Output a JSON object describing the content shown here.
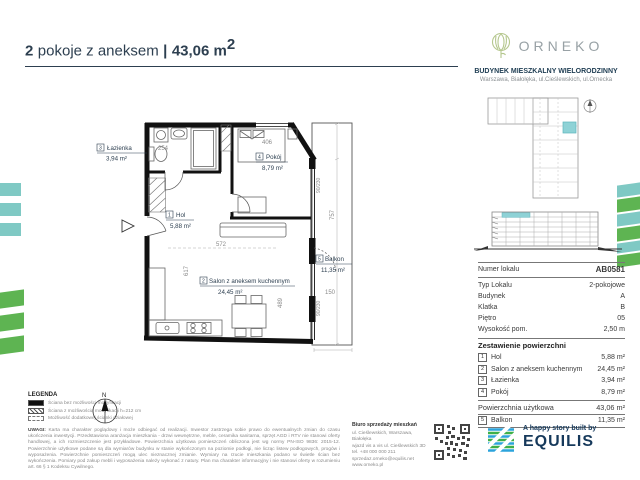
{
  "header": {
    "rooms": "2",
    "title": "pokoje z aneksem",
    "sep": "|",
    "area": "43,06 m",
    "area_sup": "2"
  },
  "brand": {
    "name": "ORNEKO",
    "building": "BUDYNEK MIESZKALNY WIELORODZINNY",
    "address": "Warszawa, Białołęka, ul.Cieślewskich, ul.Ornecka"
  },
  "unit": {
    "numer_label": "Numer lokalu",
    "numer": "AB0581",
    "info_rows": [
      {
        "label": "Typ Lokalu",
        "value": "2-pokojowe"
      },
      {
        "label": "Budynek",
        "value": "A"
      },
      {
        "label": "Klatka",
        "value": "B"
      },
      {
        "label": "Piętro",
        "value": "05"
      },
      {
        "label": "Wysokość pom.",
        "value": "2,50 m"
      }
    ],
    "zestawienie_title": "Zestawienie powierzchni",
    "rooms": [
      {
        "num": "1",
        "label": "Hol",
        "value": "5,88 m²"
      },
      {
        "num": "2",
        "label": "Salon z aneksem kuchennym",
        "value": "24,45 m²"
      },
      {
        "num": "3",
        "label": "Łazienka",
        "value": "3,94 m²"
      },
      {
        "num": "4",
        "label": "Pokój",
        "value": "8,79 m²"
      }
    ],
    "total_label": "Powierzchnia użytkowa",
    "total_value": "43,06 m²",
    "balkon": {
      "num": "5",
      "label": "Balkon",
      "value": "11,35 m²"
    }
  },
  "plan": {
    "labels": {
      "hol": {
        "num": "1",
        "name": "Hol",
        "area": "5,88 m²"
      },
      "salon": {
        "num": "2",
        "name": "Salon z aneksem kuchennym",
        "area": "24,45 m²"
      },
      "lazienka": {
        "num": "3",
        "name": "Łazienka",
        "area": "3,94 m²"
      },
      "pokoj": {
        "num": "4",
        "name": "Pokój",
        "area": "8,79 m²"
      },
      "balkon": {
        "num": "5",
        "name": "Balkon",
        "area": "11,35 m²"
      }
    },
    "dims": {
      "d254": "254",
      "d406": "406",
      "d572": "572",
      "d617": "617",
      "d489": "489",
      "d757": "757",
      "d150": "150",
      "w1": "90/230",
      "w2": "90/230"
    },
    "compass": "N"
  },
  "legend": {
    "title": "LEGENDA",
    "items": [
      "Ściana bez możliwości modyfikacji",
      "Ściana z możliwością modyfikacji h=212 cm",
      "Możliwość dodatkowej ścianki działowej"
    ]
  },
  "uwagi": {
    "label": "UWAGI:",
    "text": " Karta ma charakter poglądowy i może odbiegać od realizacji. Inwestor zastrzega sobie prawo do ewentualnych zmian do czasu ukończenia inwestycji. Przedstawiona aranżacja mieszkania - drzwi wewnętrzne, meble, ceramika sanitarna, sprzęt AGD i RTV nie stanowi oferty handlowej, a ich rozmieszczenie jest przykładowe. Powierzchnia użytkowa pomieszczeń obliczona jest wg normy PN-ISO 9836: 2015-12. Powierzchnie użytkowe podane są dla wymiarów budynku w stanie wykończonym na poziomie podłogi, nie licząc listew podłogowych, progów i wyposażenia. Powierzchnie pomieszczeń mogą ulec nieznacznej zmianie. Wymiary na rzucie mieszkania podano w świetle ścian bez wykończenia. Pomiary pod zakup mebli i wyposażenia należy wykonać z natury. Plan ma charakter informacyjny i nie stanowi oferty w rozumieniu art. 66 § 1 Kodeksu Cywilnego."
  },
  "office": {
    "title": "Biuro sprzedaży mieszkań",
    "lines": [
      "ul. Cieślewskich, Warszawa, Białołęka",
      "wjazd vis a vis ul. Cieślewskich 3D",
      "tel. +48 000 000 211",
      "sprzedaz.orneko@equilis.net",
      "www.orneko.pl"
    ]
  },
  "equilis": {
    "tagline": "A happy story built by",
    "name": "EQUILIS"
  },
  "colors": {
    "navy": "#2d3f50",
    "teal": "#7fc9c4",
    "green": "#5eb452",
    "highlight": "#8ed2d6",
    "orneko_leaf": "#b5c78e",
    "equilis_navy": "#16395b",
    "equilis_blue": "#2ba3dc",
    "equilis_green": "#3eb049"
  }
}
